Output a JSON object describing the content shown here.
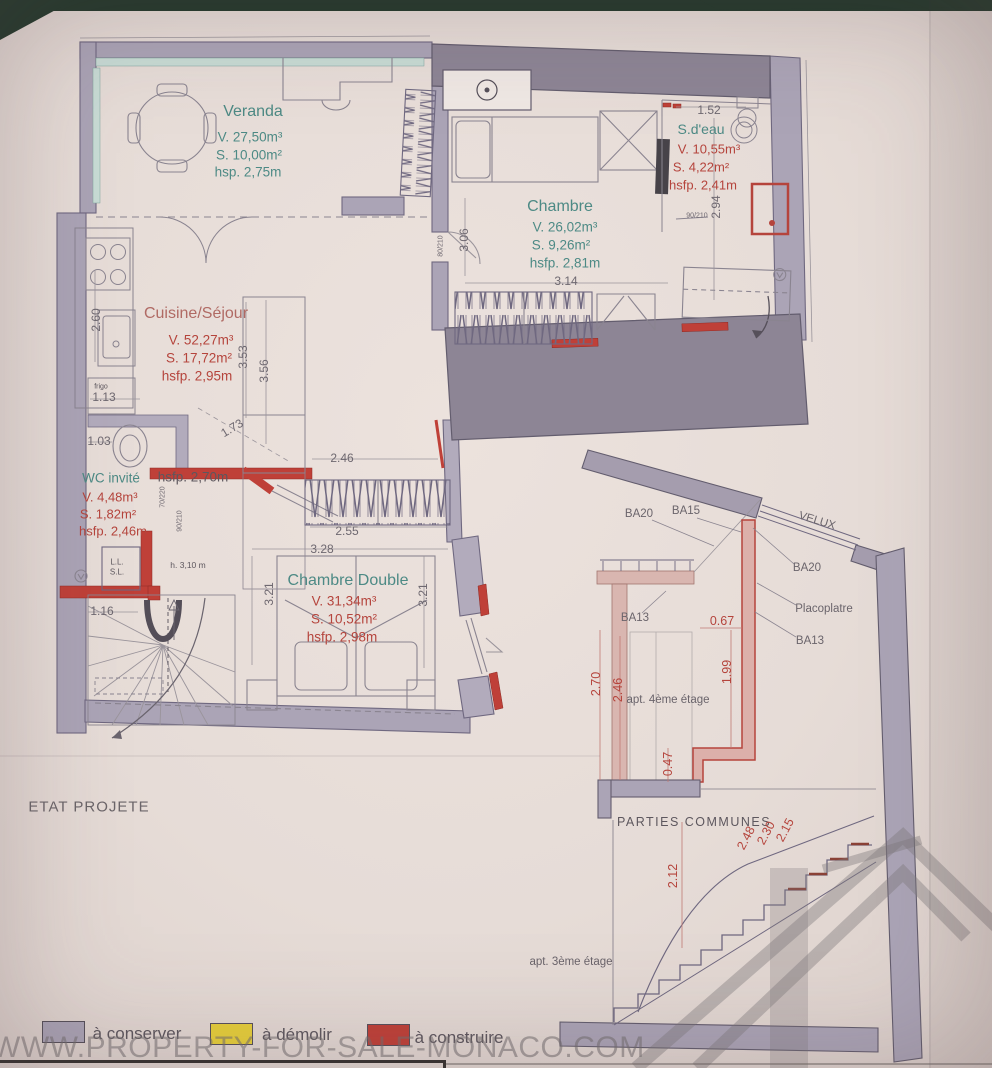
{
  "title": "ETAT PROJETE",
  "watermark": "WWW.PROPERTY-FOR-SALE-MONACO.COM",
  "colors": {
    "conserver": "#aba4b6",
    "demolir": "#e6cf3a",
    "construire": "#bf4038",
    "teal_text": "#4d8a85",
    "red_text": "#b5443c"
  },
  "legend": {
    "conserver": "à conserver",
    "demolir": "à démolir",
    "construire": "à construire"
  },
  "rooms": {
    "veranda": {
      "name": "Veranda",
      "v": "V. 27,50m³",
      "s": "S. 10,00m²",
      "h": "hsp. 2,75m"
    },
    "chambre": {
      "name": "Chambre",
      "v": "V. 26,02m³",
      "s": "S. 9,26m²",
      "h": "hsfp. 2,81m"
    },
    "sdeau": {
      "name": "S.d'eau",
      "v": "V. 10,55m³",
      "s": "S. 4,22m²",
      "h": "hsfp. 2,41m"
    },
    "cuisine": {
      "name": "Cuisine/Séjour",
      "v": "V. 52,27m³",
      "s": "S. 17,72m²",
      "h": "hsfp. 2,95m"
    },
    "wc": {
      "name": "WC invité",
      "v": "V. 4,48m³",
      "s": "S. 1,82m²",
      "h": "hsfp. 2,46m"
    },
    "chambre_double": {
      "name": "Chambre Double",
      "v": "V. 31,34m³",
      "s": "S. 10,52m²",
      "h": "hsfp. 2,98m"
    }
  },
  "annotations": {
    "hall_height": "hsfp. 2,70m",
    "stair_height": "h. 3,10 m",
    "fridge": "frigo",
    "washer_line1": "L.L.",
    "washer_line2": "S.L."
  },
  "dims": {
    "d152": "1.52",
    "d294": "2.94",
    "d306": "3.06",
    "d314": "3.14",
    "d353": "3.53",
    "d356": "3.56",
    "d260": "2.60",
    "d113": "1.13",
    "d103": "1.03",
    "d173": "1.73",
    "d246": "2.46",
    "d255": "2.55",
    "d328": "3.28",
    "d321l": "3.21",
    "d321r": "3.21",
    "d116": "1.16"
  },
  "doors": {
    "d80210": "80/210",
    "d90210a": "90/210",
    "d90210b": "90/210",
    "d70220": "70/220"
  },
  "section": {
    "ba20_top": "BA20",
    "ba15": "BA15",
    "velux": "VELUX",
    "ba20_right": "BA20",
    "placoplatre": "Placoplatre",
    "ba13_right": "BA13",
    "ba13_left": "BA13",
    "apt4": "apt. 4ème étage",
    "parties_communes": "PARTIES COMMUNES",
    "apt3": "apt. 3ème étage",
    "dims": {
      "d067": "0.67",
      "d270": "2.70",
      "d246": "2.46",
      "d199": "1.99",
      "d047": "0.47",
      "d212": "2.12",
      "d248": "2.48",
      "d230": "2.30",
      "d215": "2.15"
    }
  }
}
